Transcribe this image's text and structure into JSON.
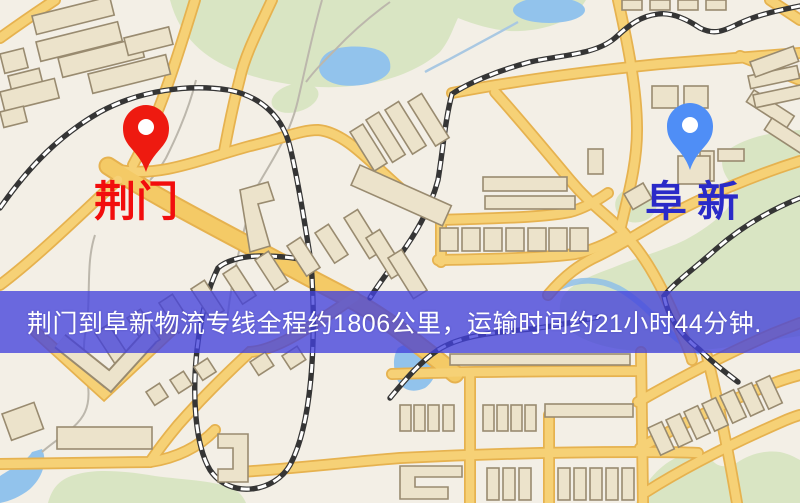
{
  "map": {
    "origin": {
      "name": "荆门",
      "pin_color": "#ee1a10",
      "label_color": "#f20d0d"
    },
    "destination": {
      "name": "阜新",
      "pin_color": "#4f8ef6",
      "label_color": "#2a2ac8"
    }
  },
  "banner": {
    "text": "荆门到阜新物流专线全程约1806公里，运输时间约21小时44分钟.",
    "background_color": "#4341db",
    "text_color": "#ffffff",
    "distance": "约1806公里",
    "duration": "约21小时44分钟"
  },
  "map_palette": {
    "background": "#f3efe6",
    "park": "#d9e5c3",
    "water": "#92c3ec",
    "road": "#f6d176",
    "road_casing": "#e6b24f",
    "railway": "#353535",
    "building_fill": "#ece3cb",
    "building_stroke": "#998b70"
  }
}
